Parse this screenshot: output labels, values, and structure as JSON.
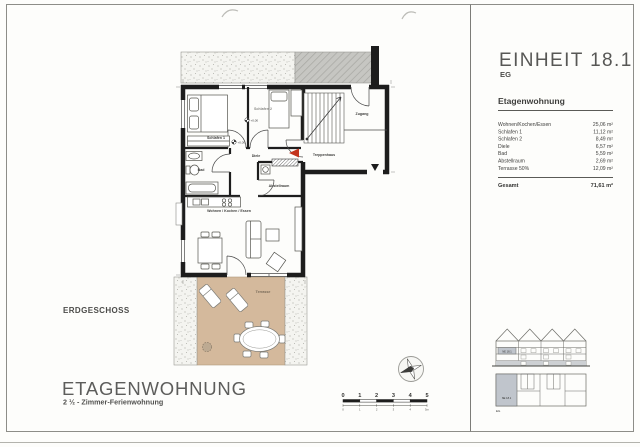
{
  "document": {
    "floor_label": "ERDGESCHOSS",
    "title": "ETAGENWOHNUNG",
    "subtitle": "2 ½ - Zimmer-Ferienwohnung"
  },
  "info_panel": {
    "unit_title": "EINHEIT 18.1",
    "unit_floor": "EG",
    "section_heading": "Etagenwohnung",
    "rows": [
      {
        "label": "Wohnen/Kochen/Essen",
        "value": "25,06 m²"
      },
      {
        "label": "Schlafen 1",
        "value": "11,12 m²"
      },
      {
        "label": "Schlafen 2",
        "value": "8,49 m²"
      },
      {
        "label": "Diele",
        "value": "6,57 m²"
      },
      {
        "label": "Bad",
        "value": "5,59 m²"
      },
      {
        "label": "Abstellraum",
        "value": "2,69 m²"
      },
      {
        "label": "Terrasse 50%",
        "value": "12,09 m²"
      }
    ],
    "total_label": "Gesamt",
    "total_value": "71,61 m²",
    "locator_unit_label": "NE 18.1",
    "locator_floor_label": "EG",
    "locator_highlight_color": "#c0c5cc"
  },
  "plan": {
    "room_labels": {
      "schlafen1": "Schlafen 1",
      "schlafen2": "Schlafen 2",
      "zugang": "Zugang",
      "treppenhaus": "Treppenhaus",
      "diele": "Diele",
      "bad": "Bad",
      "abstellraum": "Abstellraum",
      "wohnen": "Wohnen / Kochen / Essen",
      "terrasse": "Terrasse"
    },
    "level_marker": "+0,00",
    "colors": {
      "wall": "#1d1d1d",
      "terrace": "#d4b99c",
      "entry_arrow": "#c3341d"
    }
  },
  "scale_bar": {
    "ticks": [
      "0",
      "1",
      "2",
      "3",
      "4",
      "5"
    ],
    "sub_ticks": [
      "0",
      "1",
      "2",
      "3",
      "4",
      "5m"
    ]
  }
}
